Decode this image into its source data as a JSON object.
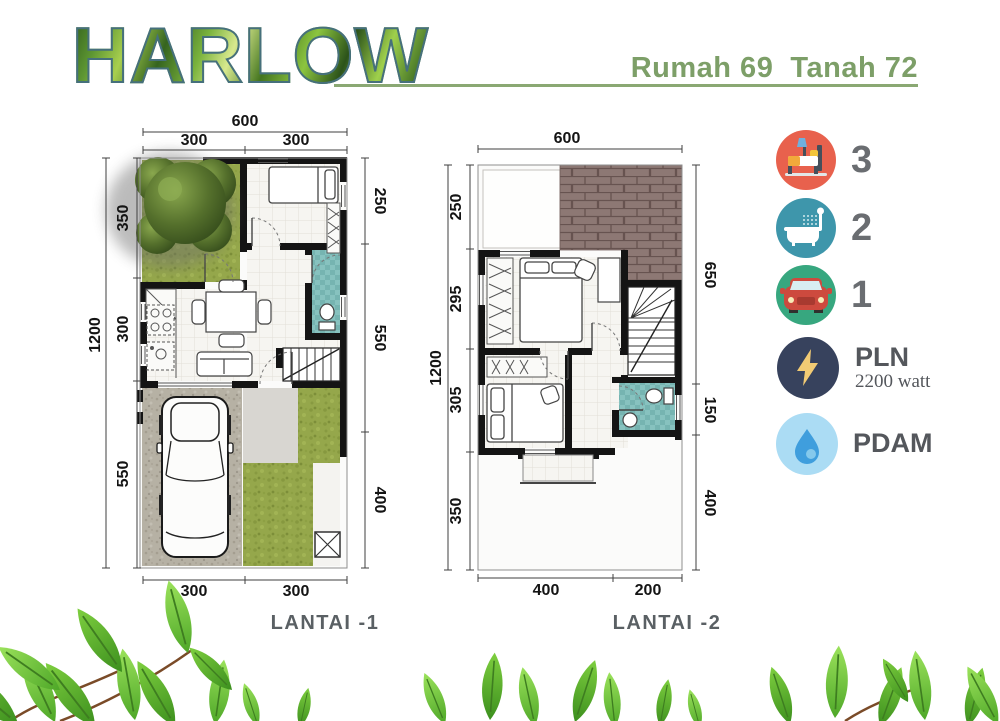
{
  "header": {
    "title": "HARLOW",
    "subtitle": "Rumah 69  Tanah 72"
  },
  "legend": {
    "bedrooms": {
      "icon": "bed-icon",
      "value": "3"
    },
    "bathrooms": {
      "icon": "bath-icon",
      "value": "2"
    },
    "carport": {
      "icon": "car-icon",
      "value": "1"
    },
    "electricity": {
      "icon": "lightning-icon",
      "label": "PLN",
      "detail": "2200 watt"
    },
    "water": {
      "icon": "water-drop-icon",
      "label": "PDAM"
    }
  },
  "plans": {
    "plan1": {
      "label": "LANTAI -1",
      "dims": {
        "top_total": "600",
        "top": [
          "300",
          "300"
        ],
        "left_total": "1200",
        "left": [
          "350",
          "300",
          "550"
        ],
        "right": [
          "250",
          "550",
          "400"
        ],
        "bottom": [
          "300",
          "300"
        ]
      }
    },
    "plan2": {
      "label": "LANTAI -2",
      "dims": {
        "top_total": "600",
        "left_total": "1200",
        "left": [
          "250",
          "295",
          "305",
          "350"
        ],
        "right": [
          "650",
          "150",
          "400"
        ],
        "bottom": [
          "400",
          "200"
        ]
      }
    }
  },
  "colors": {
    "accent_green": "#8aa873",
    "subtitle_green": "#7d9f68",
    "title_outline": "#46707c",
    "bed_icon_bg": "#e8614d",
    "bath_icon_bg": "#3e96ab",
    "car_icon_bg": "#37a77f",
    "pln_icon_bg": "#37425d",
    "pdam_icon_bg": "#abdcf4",
    "bathroom_floor": "#87c2bf",
    "grass": "#95a74b",
    "gravel": "#b6b1a4",
    "roof_tile": "#8d7874"
  }
}
